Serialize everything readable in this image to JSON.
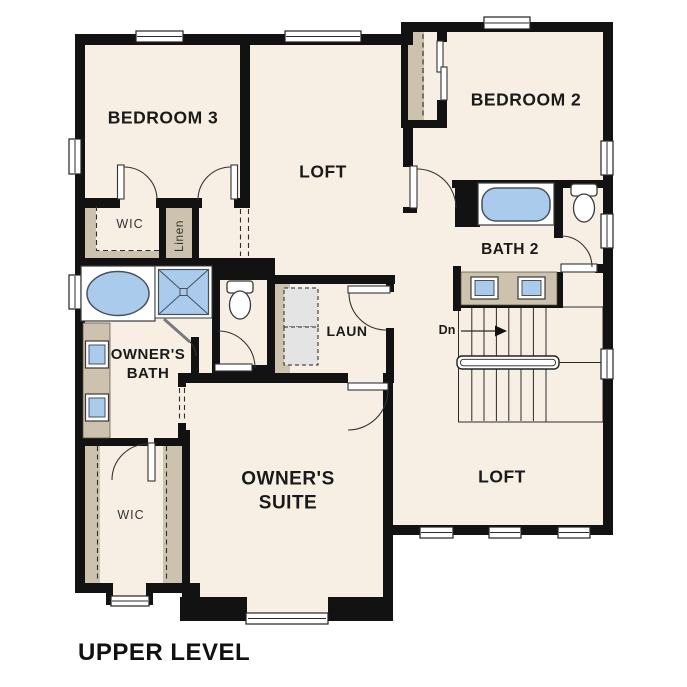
{
  "title": "UPPER LEVEL",
  "colors": {
    "floor": "#f7efe4",
    "wall": "#121212",
    "cabinet": "#cdc2ae",
    "fixture": "#aacbec",
    "fixstroke": "#48525c",
    "appliance": "#e4e4e4"
  },
  "labels": {
    "bedroom3": "BEDROOM 3",
    "loft_upper": "LOFT",
    "bedroom2": "BEDROOM 2",
    "wic_upper": "WIC",
    "linen": "Linen",
    "bath2": "BATH 2",
    "laundry": "LAUN",
    "owners_bath_line1": "OWNER'S",
    "owners_bath_line2": "BATH",
    "owners_suite_line1": "OWNER'S",
    "owners_suite_line2": "SUITE",
    "loft_lower": "LOFT",
    "wic_lower": "WIC",
    "stairs_direction": "Dn"
  }
}
